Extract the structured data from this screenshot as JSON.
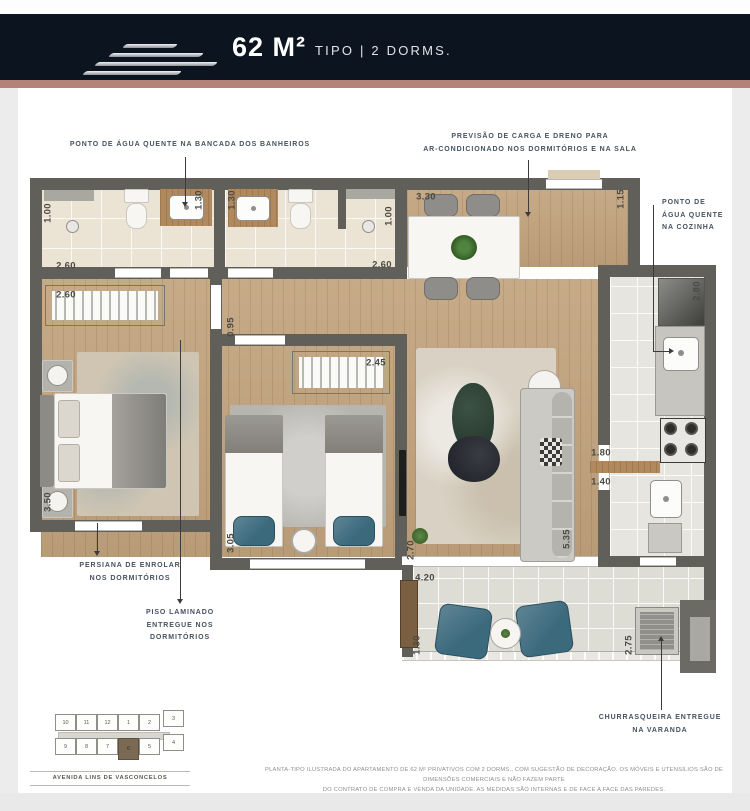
{
  "header": {
    "title_main": "62 M²",
    "title_sub": "TIPO | 2 DORMS.",
    "bg_color": "#0c151f",
    "accent_bar_color": "#b28376",
    "logo": "brand-speed-lines-logo"
  },
  "annotations": {
    "hot_water_bath": [
      "PONTO DE ÁGUA QUENTE NA BANCADA DOS BANHEIROS"
    ],
    "ac_provision": [
      "PREVISÃO DE CARGA E DRENO PARA",
      "AR-CONDICIONADO NOS DORMITÓRIOS E NA SALA"
    ],
    "hot_water_kitchen": [
      "PONTO DE",
      "ÁGUA QUENTE",
      "NA COZINHA"
    ],
    "blinds": [
      "PERSIANA DE ENROLAR",
      "NOS DORMITÓRIOS"
    ],
    "laminate_floor": [
      "PISO LAMINADO",
      "ENTREGUE NOS",
      "DORMITÓRIOS"
    ],
    "barbecue": [
      "CHURRASQUEIRA ENTREGUE",
      "NA VARANDA"
    ]
  },
  "dims": [
    "1.00",
    "2.60",
    "2.60",
    "1.30",
    "1.30",
    "1.00",
    "2.60",
    "3.30",
    "1.15",
    "2.80",
    "0.95",
    "2.45",
    "3.50",
    "3.05",
    "2.70",
    "5.35",
    "1.80",
    "1.40",
    "4.20",
    "1.30",
    "2.75"
  ],
  "site_plan": {
    "units_top": [
      "10",
      "11",
      "12",
      "1",
      "2",
      "3"
    ],
    "units_bottom": [
      "9",
      "8",
      "7",
      "6",
      "5",
      "4"
    ],
    "highlighted_unit": "6",
    "street": "AVENIDA LINS DE VASCONCELOS"
  },
  "disclaimer": {
    "line1": "PLANTA-TIPO ILUSTRADA DO APARTAMENTO DE 62 M² PRIVATIVOS COM 2 DORMS., COM SUGESTÃO DE DECORAÇÃO. OS MÓVEIS E UTENSÍLIOS SÃO DE DIMENSÕES COMERCIAIS E NÃO FAZEM PARTE",
    "line2": "DO CONTRATO DE COMPRA E VENDA DA UNIDADE. AS MEDIDAS SÃO INTERNAS E DE FACE A FACE DAS PAREDES."
  }
}
